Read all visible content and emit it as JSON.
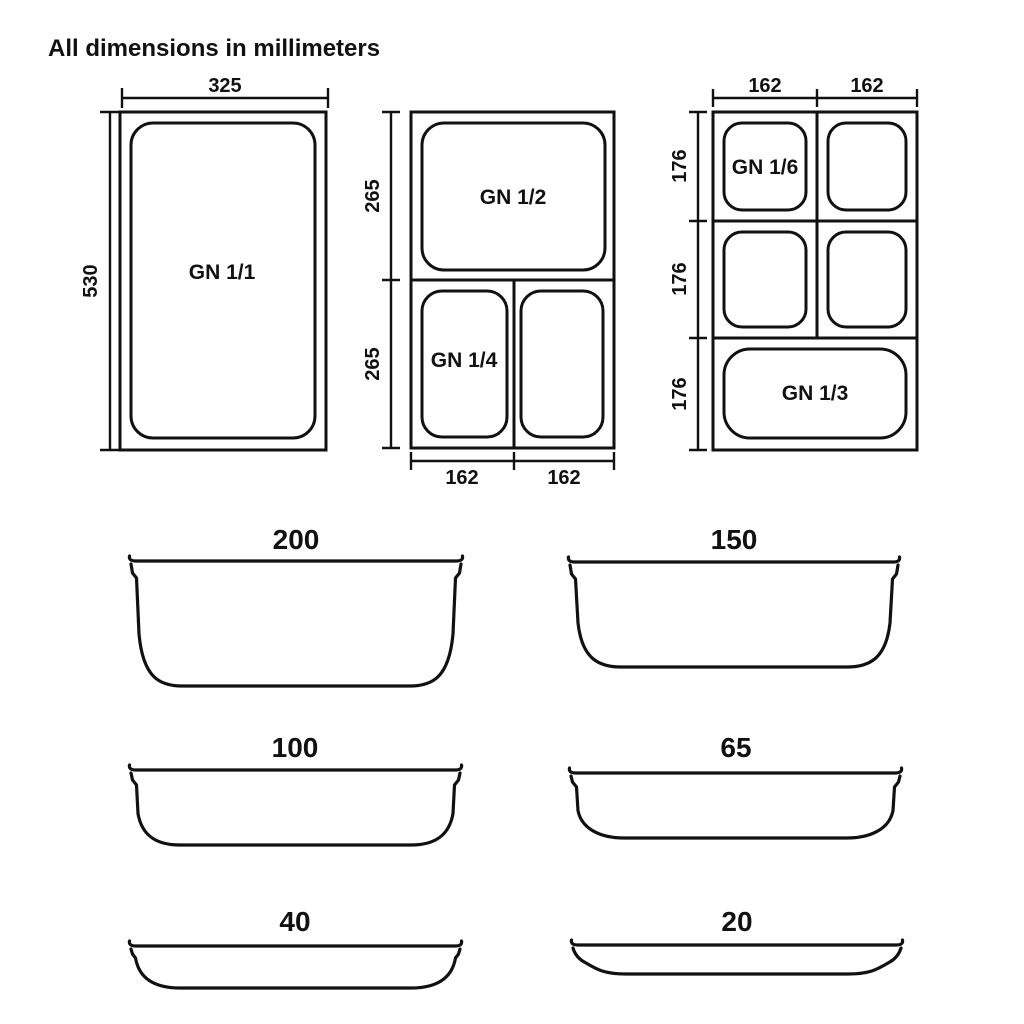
{
  "title": "All dimensions in millimeters",
  "plan_views": {
    "gn_1_1": {
      "label": "GN 1/1",
      "width_mm": "325",
      "height_mm": "530"
    },
    "gn_1_2_1_4": {
      "top_label": "GN 1/2",
      "bottom_left_label": "GN 1/4",
      "top_height_mm": "265",
      "bottom_height_mm": "265",
      "bottom_left_width_mm": "162",
      "bottom_right_width_mm": "162"
    },
    "gn_1_6_1_3": {
      "top_left_label": "GN 1/6",
      "bottom_label": "GN 1/3",
      "left_width_mm": "162",
      "right_width_mm": "162",
      "row1_height_mm": "176",
      "row2_height_mm": "176",
      "row3_height_mm": "176"
    }
  },
  "depth_profiles": [
    {
      "depth_mm": "200"
    },
    {
      "depth_mm": "150"
    },
    {
      "depth_mm": "100"
    },
    {
      "depth_mm": "65"
    },
    {
      "depth_mm": "40"
    },
    {
      "depth_mm": "20"
    }
  ],
  "colors": {
    "line": "#111111",
    "background": "#ffffff"
  }
}
